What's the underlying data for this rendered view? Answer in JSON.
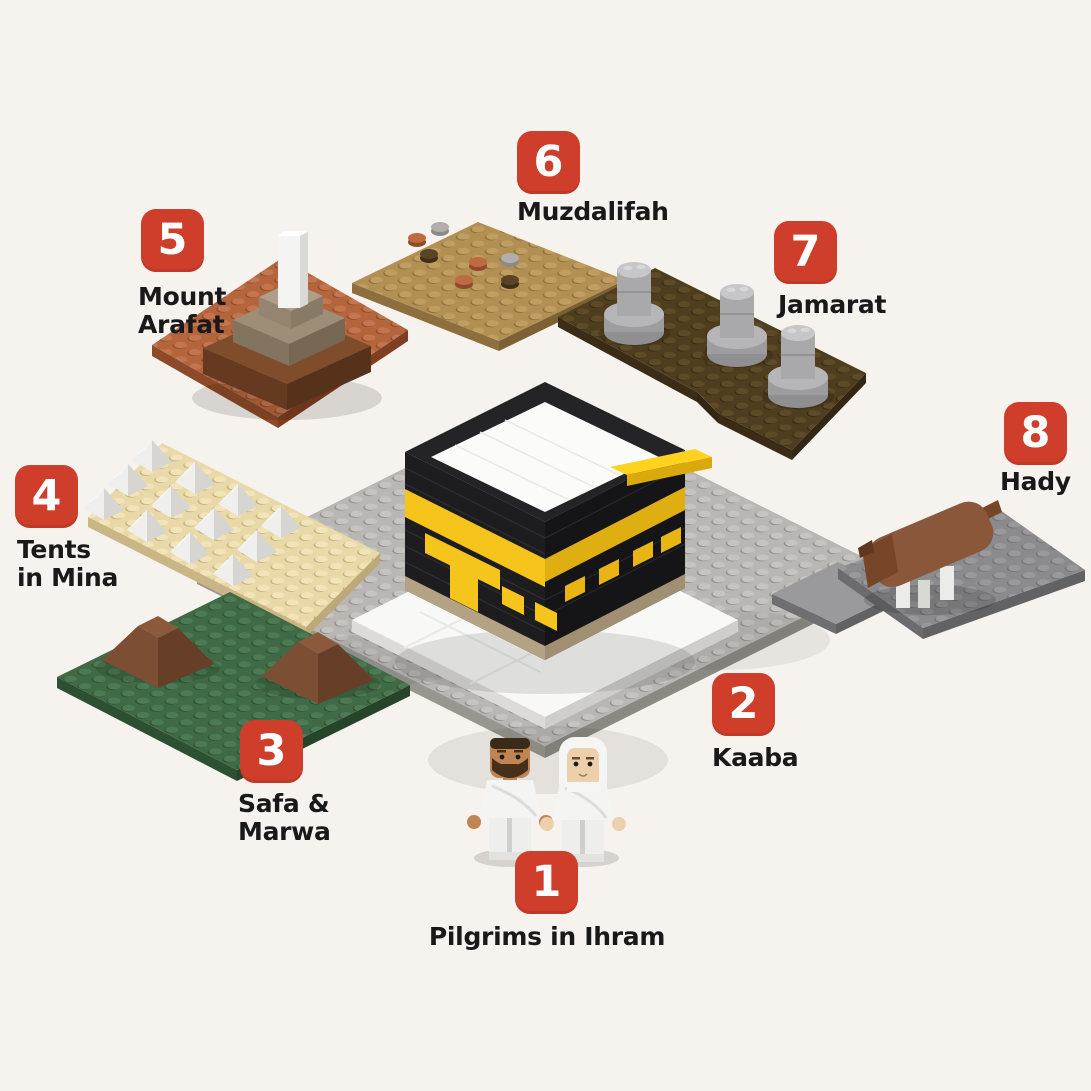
{
  "canvas": {
    "width": 1091,
    "height": 1091,
    "background": "#f6f3ee"
  },
  "style": {
    "badge_bg": "#cf3e2b",
    "badge_text": "#ffffff",
    "label_color": "#191919"
  },
  "steps": [
    {
      "number": "1",
      "label": "Pilgrims in Ihram",
      "lines": [
        "Pilgrims in Ihram"
      ]
    },
    {
      "number": "2",
      "label": "Kaaba",
      "lines": [
        "Kaaba"
      ]
    },
    {
      "number": "3",
      "label": "Safa & Marwa",
      "lines": [
        "Safa &",
        "Marwa"
      ]
    },
    {
      "number": "4",
      "label": "Tents in Mina",
      "lines": [
        "Tents",
        "in Mina"
      ]
    },
    {
      "number": "5",
      "label": "Mount Arafat",
      "lines": [
        "Mount",
        "Arafat"
      ]
    },
    {
      "number": "6",
      "label": "Muzdalifah",
      "lines": [
        "Muzdalifah"
      ]
    },
    {
      "number": "7",
      "label": "Jamarat",
      "lines": [
        "Jamarat"
      ]
    },
    {
      "number": "8",
      "label": "Hady",
      "lines": [
        "Hady"
      ]
    }
  ],
  "models": {
    "kaaba": {
      "body": "#1d1d20",
      "band": "#f6c51b",
      "roof": "#fbfbf9",
      "base": "#b3a283",
      "courtyard_plate": "#b8b7b4",
      "platform": "#f8f8f7"
    },
    "pilgrims": {
      "garment": "#f3f3f1",
      "skin_male": "#c08552",
      "skin_female": "#ecd0ac"
    },
    "safa_marwa": {
      "plate": "#3f6a45",
      "hills": "#8b5a3c"
    },
    "tents_in_mina": {
      "plate": "#e9d9a8",
      "tents": "#ededeb"
    },
    "mount_arafat": {
      "plate": "#b4653c",
      "mound_lower": "#7f4c2c",
      "mound_upper": "#9e8e77",
      "pillar": "#f4f4f2"
    },
    "muzdalifah": {
      "plate": "#b28f53",
      "pebbles": [
        "#c06a40",
        "#b0afac",
        "#5a4426"
      ]
    },
    "jamarat": {
      "plate": "#4f3d1f",
      "pillars": "#a9a9ac"
    },
    "hady": {
      "plate": "#8b8a8c",
      "sheep": "#8a573a",
      "legs": "#ebebe9"
    }
  }
}
